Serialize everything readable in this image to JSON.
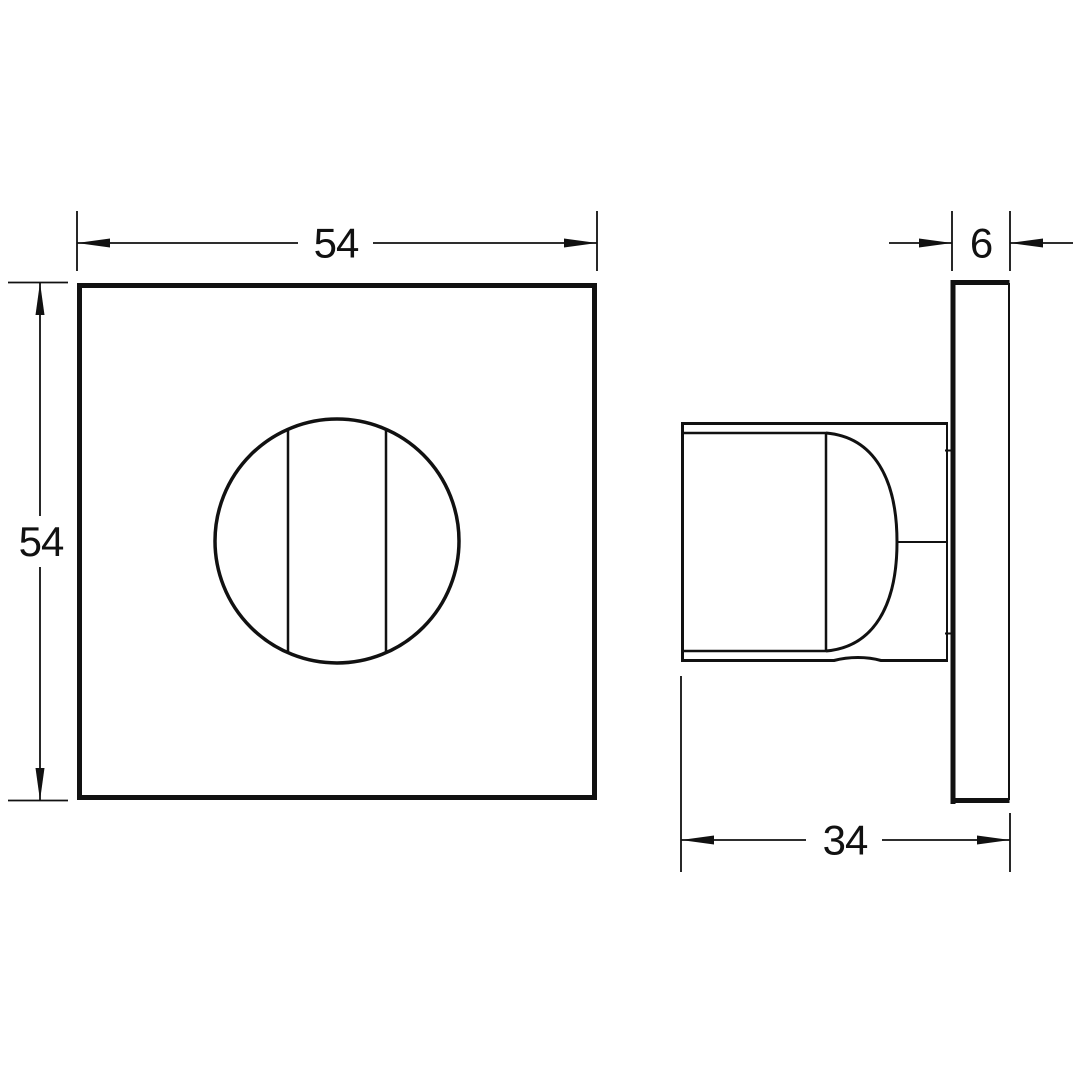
{
  "colors": {
    "line": "#111111",
    "background": "#ffffff"
  },
  "dimensions": {
    "front_width": "54",
    "front_height": "54",
    "plate_thickness": "6",
    "knob_projection": "34"
  }
}
